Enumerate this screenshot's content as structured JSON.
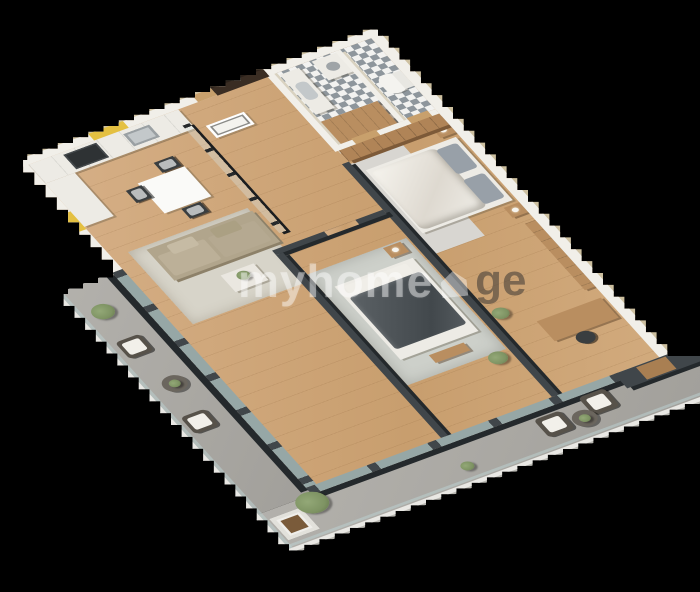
{
  "watermark": {
    "text_primary": "myhome",
    "text_suffix": "ge",
    "icon": "house-icon"
  },
  "palette": {
    "bg": "#000000",
    "wood": "#cfa77a",
    "wall_light": "#f1efe9",
    "wall_side": "#cdc0a0",
    "wall_dark": "#40464a",
    "wall_dark_side": "#24292c",
    "balcony_floor": "#aaa8a3",
    "railing": "#e9e8e4",
    "glass": "#bcd0cf",
    "tile_dark": "#8e969c",
    "tile_light": "#f2f2f0",
    "yellow": "#e4c041",
    "rug_living": "#d7d4c9",
    "rug_gray": "#cdd0ca",
    "rug_bed1": "#d8d6d1",
    "sofa": "#b1a58c",
    "blanket_dark": "#51575b",
    "wood_furn": "#b98e60",
    "door_dark": "#3a2d23",
    "door_wood": "#c8a06c",
    "bed_white": "#edebe5",
    "pillow_gray": "#98a0a8",
    "green_plant": "#7e9363",
    "pot_brown": "#8a6f4e",
    "concrete": "#6b665e",
    "watermark_light": "#ffffff6b",
    "watermark_dark": "#3b37338c"
  }
}
